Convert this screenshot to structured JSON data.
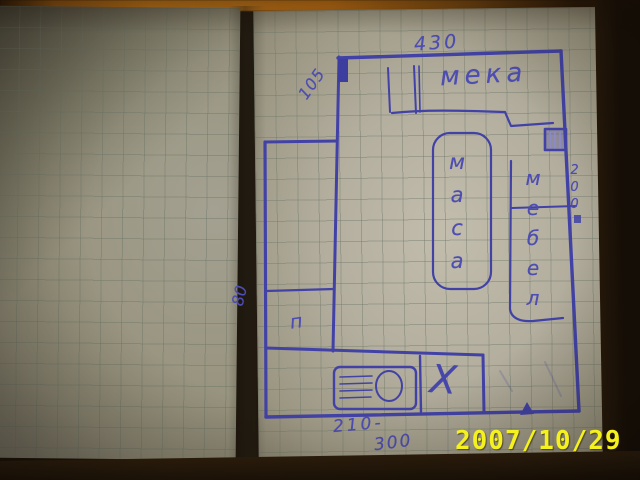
{
  "photo": {
    "date_stamp": "2007/10/29",
    "colors": {
      "ink_blue": "#4545a8",
      "paper_right": "#b3ae9e",
      "paper_left": "#97937e",
      "date_yellow": "#f4f11e",
      "top_strip_orange": "#c07014",
      "frame_dark": "#170f06"
    }
  },
  "plan": {
    "dimensions": {
      "top_width": "430",
      "left_upper": "105",
      "left_lower": "80",
      "right_side": "200",
      "bottom_left": "210-",
      "bottom_total": "300"
    },
    "labels": {
      "sofa_top": "мека",
      "sofa_right": "мебел",
      "table": "маса",
      "small_room": "п",
      "crossed_area": "X"
    }
  }
}
